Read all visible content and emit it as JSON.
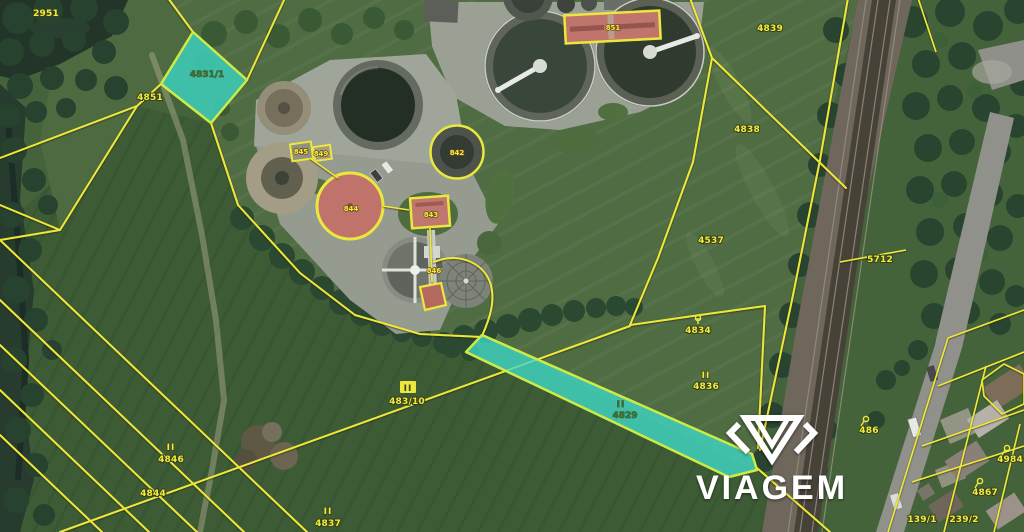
{
  "brand": {
    "name": "VIAGEM"
  },
  "map": {
    "colors": {
      "highlight_fill": "#3BD8C6",
      "highlight_edge": "#CDEB46",
      "cadastral_line": "#EDE73A",
      "building_highlight": "#BF746C"
    }
  },
  "cadastral": {
    "meadow_marker": "II",
    "parcels": {
      "tl_corner": "2951",
      "west": "4851",
      "quad_highlight": "4831/1",
      "field_top": "4839",
      "field_mid": "4838",
      "field_low": "4537",
      "rail_east": "5712",
      "grove": "4834",
      "east_meadow": "4836",
      "strip_highlight": "4829",
      "center_meadow": "483/10",
      "west_meadow": "4846",
      "west_strip": "4844",
      "south_meadow": "4837",
      "tree_lane": "486",
      "house_ne": "4984",
      "house_mid": "4867",
      "house_sw": "139/1",
      "house_s": "239/2"
    },
    "buildings": {
      "hall": "851",
      "shed_a": "845",
      "shed_b": "849",
      "digester": "844",
      "pump_house": "843",
      "ring_tank": "842",
      "outbuilding": "846"
    }
  }
}
